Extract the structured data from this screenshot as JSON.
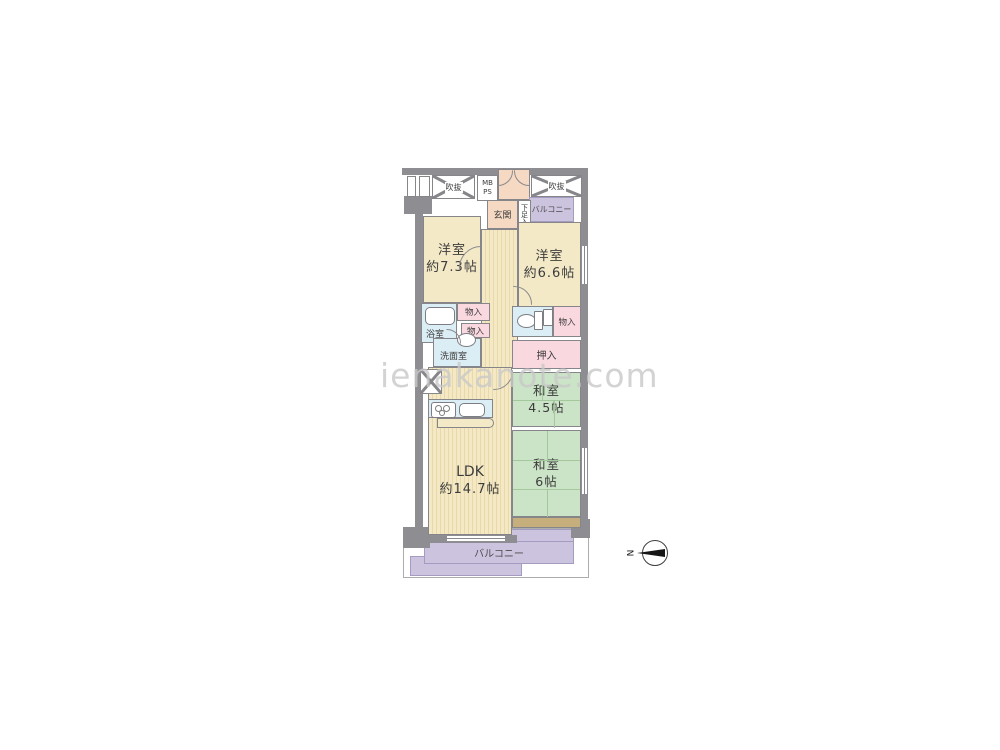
{
  "watermark": "ienakanote.com",
  "compass": {
    "n": "N"
  },
  "labels": {
    "fukinuke_left": "吹抜",
    "fukinuke_right": "吹抜",
    "mb": "MB",
    "ps": "PS",
    "genkan": "玄関",
    "getabako": "下足入",
    "balcony_top": "バルコニー",
    "balcony_bottom": "バルコニー",
    "bath": "浴室",
    "washroom": "洗面室",
    "storage_1": "物入",
    "storage_2": "物入",
    "storage_3": "物入",
    "oshiire": "押入"
  },
  "rooms": {
    "western1": {
      "name": "洋室",
      "size": "約7.3帖"
    },
    "western2": {
      "name": "洋室",
      "size": "約6.6帖"
    },
    "japanese1": {
      "name": "和室",
      "size": "4.5帖"
    },
    "japanese2": {
      "name": "和室",
      "size": "6帖"
    },
    "ldk": {
      "name": "LDK",
      "size": "約14.7帖"
    }
  },
  "colors": {
    "room_cream": "#F4E9C7",
    "flooring_stripe": "#E7D9AB",
    "tatami_green": "#CBE3C6",
    "closet_pink": "#F9D8E0",
    "water_blue": "#DCEEF5",
    "balcony_purple": "#CCC4DF",
    "entry_salmon": "#F6D9C3",
    "wood_tan": "#C7AE7D",
    "wall_gray": "#8E8E92"
  }
}
